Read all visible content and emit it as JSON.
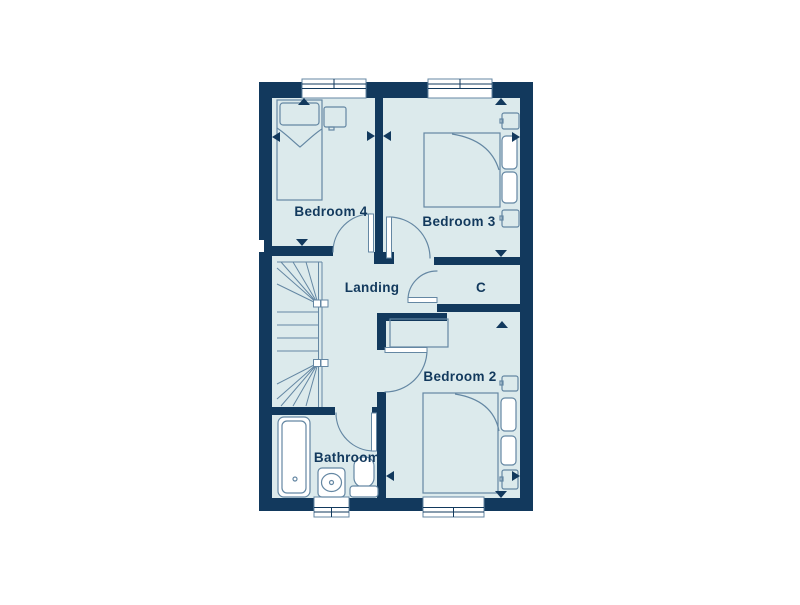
{
  "floorplan": {
    "rooms": [
      {
        "id": "bedroom-4",
        "label": "Bedroom 4"
      },
      {
        "id": "bedroom-3",
        "label": "Bedroom 3"
      },
      {
        "id": "landing",
        "label": "Landing"
      },
      {
        "id": "cupboard",
        "label": "C"
      },
      {
        "id": "bedroom-2",
        "label": "Bedroom 2"
      },
      {
        "id": "bathroom",
        "label": "Bathroom"
      }
    ],
    "icons": [
      "single-bed-icon",
      "double-bed-icon",
      "wardrobe-icon",
      "bedside-table-icon",
      "stairs-icon",
      "bath-icon",
      "sink-icon",
      "toilet-icon",
      "door-icon",
      "window-icon",
      "dimension-arrow-icon"
    ],
    "colors": {
      "wall": "#12395d",
      "room_fill": "#dceaec",
      "furniture_line": "#6487a3",
      "fixture_fill": "#ffffff",
      "label_text": "#12395d",
      "background": "#ffffff"
    }
  }
}
